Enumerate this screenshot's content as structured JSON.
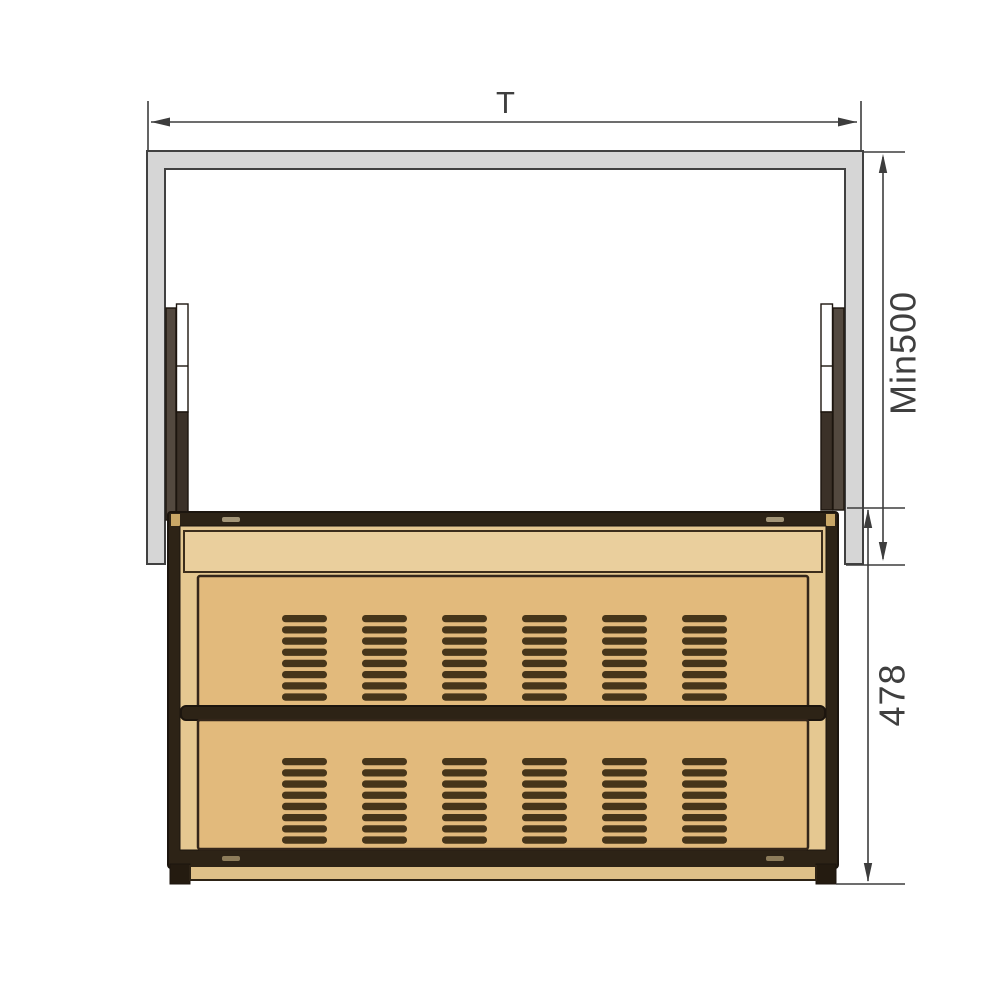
{
  "dimensions": {
    "cabinet_width_label": "T",
    "min_height_label": "Min500",
    "unit_height_label": "478"
  },
  "colors": {
    "background": "#ffffff",
    "panel_fill": "#d6d6d6",
    "panel_stroke": "#414141",
    "dim_line": "#3d3d3d",
    "dim_text": "#3f3f3f",
    "frame_dark": "#2d2316",
    "frame_stroke": "#1c150e",
    "wood_face": "#e2ba7c",
    "wood_light": "#eacf9d",
    "wood_inner": "#e5c891",
    "plinth": "#dec089",
    "slat": "#46351a",
    "rail_bracket": "#53493f",
    "rail_dark": "#3b3128"
  }
}
